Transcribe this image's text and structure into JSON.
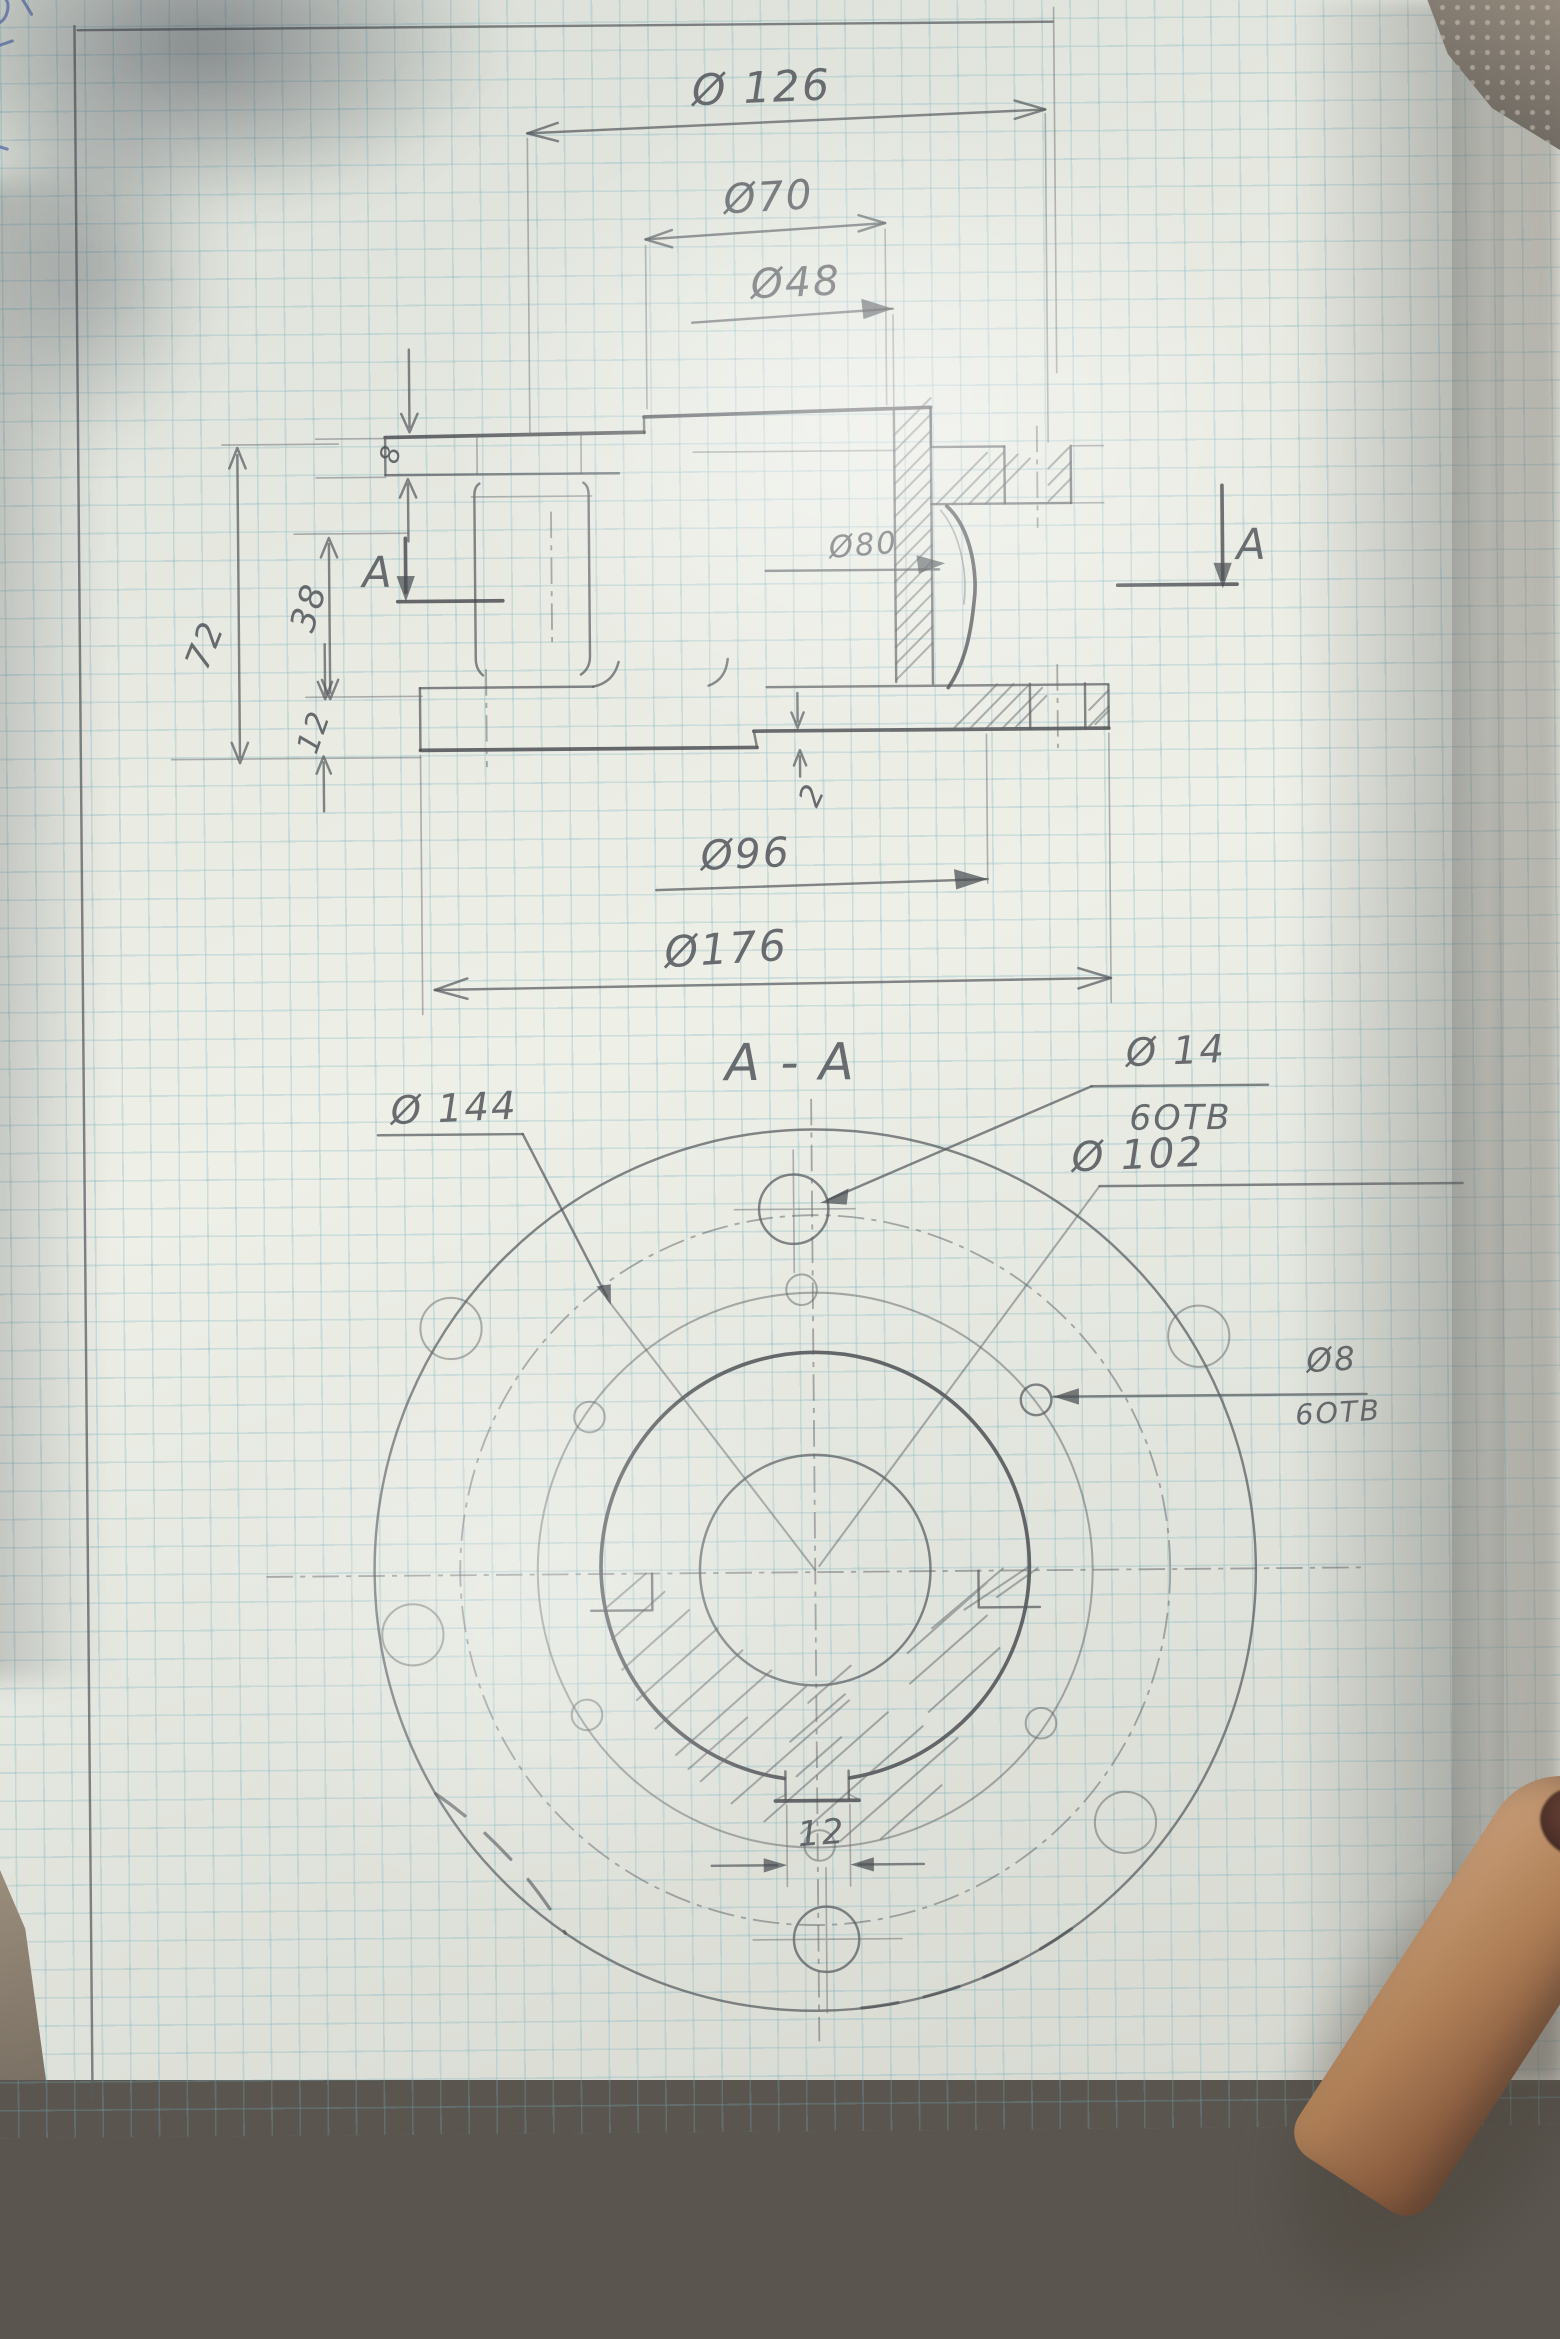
{
  "drawing": {
    "kind": "hand-drawn engineering drawing of a flanged hub, pencil on graph paper",
    "front_view": {
      "dims": {
        "d126": "Ø 126",
        "d70": "Ø70",
        "d48": "Ø48",
        "d80": "Ø80",
        "d96": "Ø96",
        "d176": "Ø176",
        "h8": "8",
        "h72": "72",
        "h38": "38",
        "h12": "12",
        "h2": "2"
      },
      "section_marker_left": "A",
      "section_marker_right": "A"
    },
    "section_view": {
      "title": "A - A",
      "dims": {
        "d144": "Ø 144",
        "d14": "Ø 14",
        "d14_holes": "6ОТВ",
        "d102": "Ø 102",
        "d8": "Ø8",
        "d8_holes": "6ОТВ",
        "keyway_width": "12"
      }
    },
    "colors": {
      "pencil": "#55585c",
      "grid": "#74acbc",
      "paper": "#e6e8e1",
      "ink": "#3a56a8"
    }
  }
}
